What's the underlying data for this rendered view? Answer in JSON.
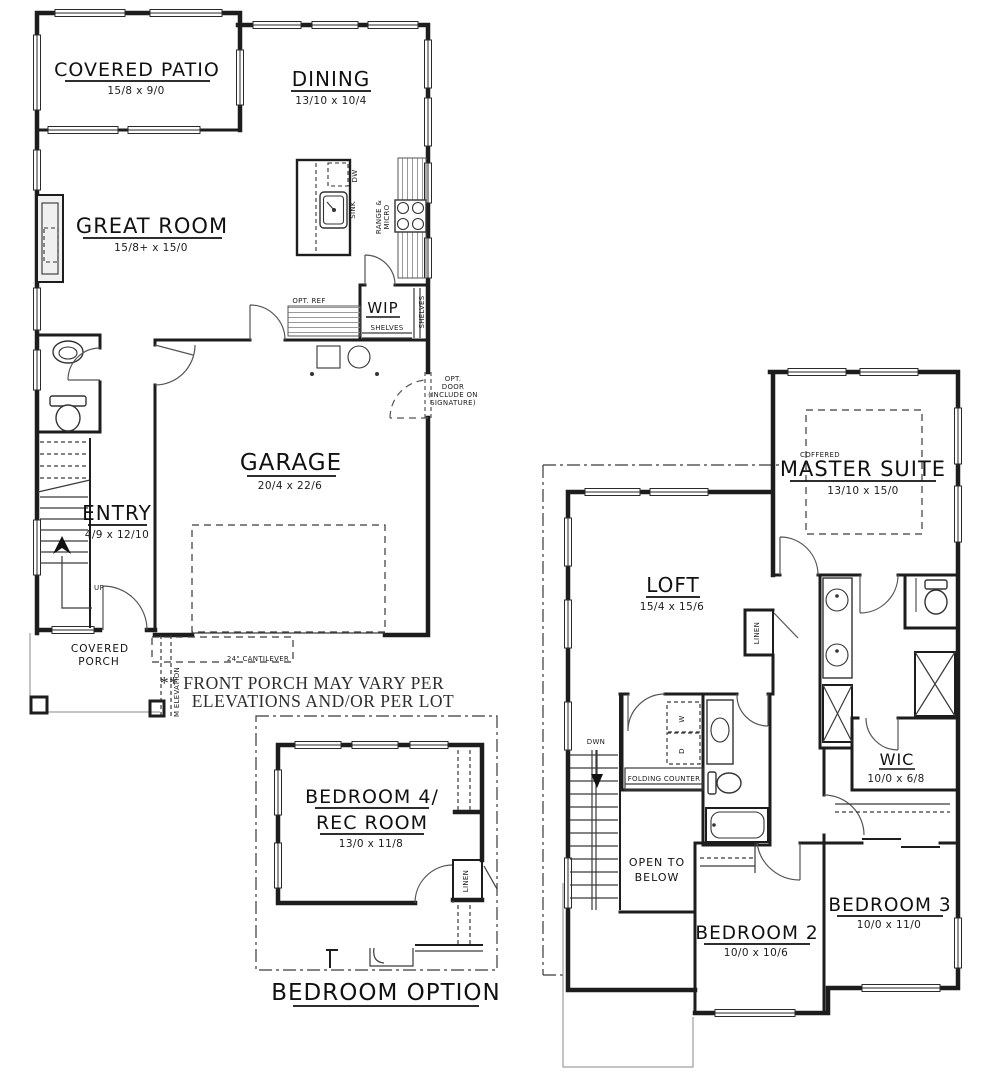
{
  "note": {
    "line1": "** FRONT PORCH  MAY VARY PER",
    "line2": "ELEVATIONS AND/OR PER LOT"
  },
  "first_floor": {
    "covered_patio": {
      "label": "COVERED PATIO",
      "dims": "15/8 x 9/0"
    },
    "dining": {
      "label": "DINING",
      "dims": "13/10 x 10/4"
    },
    "great_room": {
      "label": "GREAT ROOM",
      "dims": "15/8+ x 15/0"
    },
    "garage": {
      "label": "GARAGE",
      "dims": "20/4 x 22/6"
    },
    "entry": {
      "label": "ENTRY",
      "dims": "4/9 x 12/10"
    },
    "wip_label": "WIP",
    "porch_line1": "COVERED",
    "porch_line2": "PORCH",
    "sink": "SINK",
    "dw": "DW",
    "range1": "RANGE &",
    "range2": "MICRO",
    "opt_ref": "OPT. REF",
    "shelves_v": "SHELVES",
    "shelves_h": "SHELVES",
    "up": "UP",
    "opt_door1": "OPT.",
    "opt_door2": "DOOR",
    "opt_door3": "(INCLUDE ON",
    "opt_door4": "SIGNATURE)",
    "cantilever": "24\" CANTILEVER",
    "elevation": "M ELEVATION"
  },
  "second_floor": {
    "master": {
      "pre": "COFFERED",
      "label": "MASTER SUITE",
      "dims": "13/10 x 15/0"
    },
    "loft": {
      "label": "LOFT",
      "dims": "15/4 x 15/6"
    },
    "wic": {
      "label": "WIC",
      "dims": "10/0 x 6/8"
    },
    "bedroom2": {
      "label": "BEDROOM 2",
      "dims": "10/0 x 10/6"
    },
    "bedroom3": {
      "label": "BEDROOM 3",
      "dims": "10/0 x 11/0"
    },
    "dwn": "DWN",
    "open1": "OPEN TO",
    "open2": "BELOW",
    "folding_counter": "FOLDING COUNTER",
    "linen": "LINEN",
    "washer": "W",
    "dryer": "D"
  },
  "bedroom_option": {
    "title": "BEDROOM OPTION",
    "bedroom4_line1": "BEDROOM 4/",
    "bedroom4_line2": "REC ROOM",
    "bedroom4_dims": "13/0 x 11/8",
    "linen": "LINEN"
  },
  "colors": {
    "line": "#1d1d1d",
    "background": "#ffffff"
  }
}
